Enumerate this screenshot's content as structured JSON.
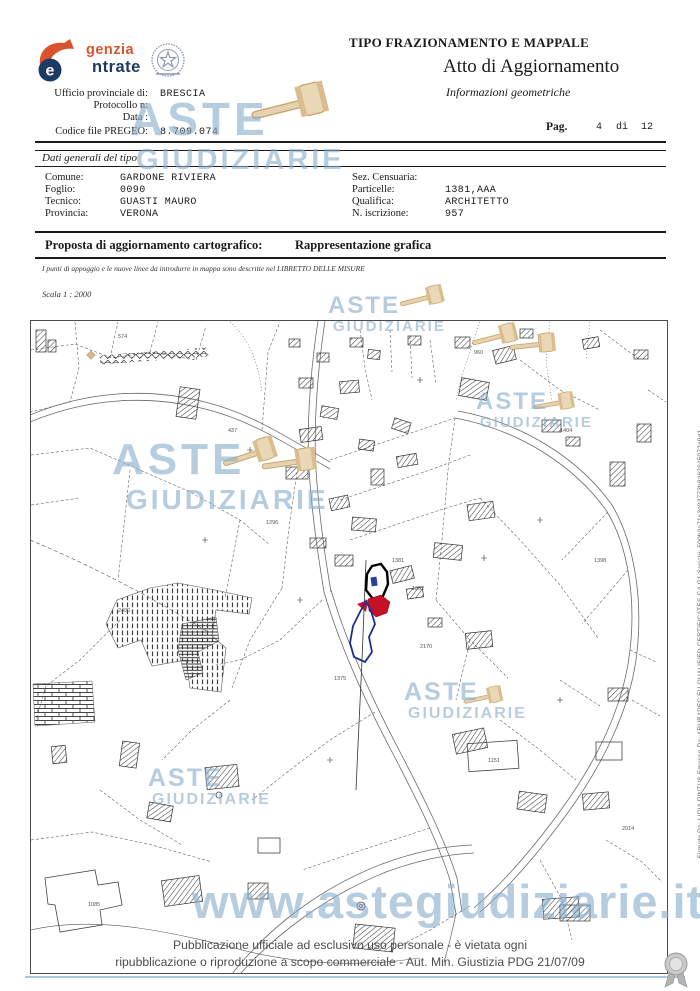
{
  "header": {
    "logo": {
      "word_top": "genzia",
      "word_bottom": "ntrate",
      "letter": "e"
    },
    "doc_type": "TIPO FRAZIONAMENTO E MAPPALE",
    "doc_subtitle": "Atto di Aggiornamento",
    "doc_info": "Informazioni geometriche",
    "fields": [
      {
        "label": "Ufficio provinciale di:",
        "value": "BRESCIA"
      },
      {
        "label": "Protocollo n:",
        "value": ""
      },
      {
        "label": "Data :",
        "value": ""
      },
      {
        "label": "Codice file PREGEO:",
        "value": "8.709.074"
      }
    ],
    "page": {
      "label": "Pag.",
      "current": "4",
      "of": "di",
      "total": "12"
    }
  },
  "dati_generali": {
    "title": "Dati generali del tipo",
    "left": [
      {
        "label": "Comune:",
        "value": "GARDONE RIVIERA"
      },
      {
        "label": "Foglio:",
        "value": "0090"
      },
      {
        "label": "Tecnico:",
        "value": "GUASTI MAURO"
      },
      {
        "label": "Provincia:",
        "value": "VERONA"
      }
    ],
    "right": [
      {
        "label": "Sez. Censuaria:",
        "value": ""
      },
      {
        "label": "Particelle:",
        "value": "1381,AAA"
      },
      {
        "label": "Qualifica:",
        "value": "ARCHITETTO"
      },
      {
        "label": "N. iscrizione:",
        "value": "957"
      }
    ]
  },
  "proposta": {
    "label": "Proposta di aggiornamento cartografico:",
    "value": "Rappresentazione grafica"
  },
  "note": "I punti di appoggio e le nuove linee da introdurre in mappa sono descritte nel LIBRETTO DELLE MISURE",
  "scala": "Scala 1 : 2000",
  "map": {
    "parcel_labels": [
      {
        "t": "1381"
      },
      {
        "t": "1382"
      },
      {
        "t": "2170"
      },
      {
        "t": "1375"
      },
      {
        "t": "1296"
      },
      {
        "t": "574"
      },
      {
        "t": "960"
      },
      {
        "t": "1398"
      },
      {
        "t": "1404"
      },
      {
        "t": "437"
      },
      {
        "t": "1151"
      },
      {
        "t": "2014"
      },
      {
        "t": "1085"
      },
      {
        "t": "2400"
      }
    ]
  },
  "watermark": {
    "line1": "ASTE",
    "line2": "GIUDIZIARIE",
    "url": "www.astegiudiziarie.it"
  },
  "footer": {
    "line1": "Pubblicazione ufficiale ad esclusivo uso personale - è vietata ogni",
    "line2": "ripubblicazione o riproduzione a scopo commerciale - Aut. Min. Giustizia PDG 21/07/09"
  },
  "signature": "Firmato Da: LIDIA PINTUS Emesso Da: ARUBAPEC EU QUALIFIED CERTIFICATES CA G1 Serial#: 500b0a71c3d93773b9d62645072a9d1",
  "colors": {
    "accent_orange": "#d9532f",
    "accent_navy": "#1c3a63",
    "watermark_blue": "#8daecb",
    "parcel_red": "#c51025",
    "parcel_blue": "#1b2f8f",
    "bottom_line_blue": "#a9c7e2"
  }
}
